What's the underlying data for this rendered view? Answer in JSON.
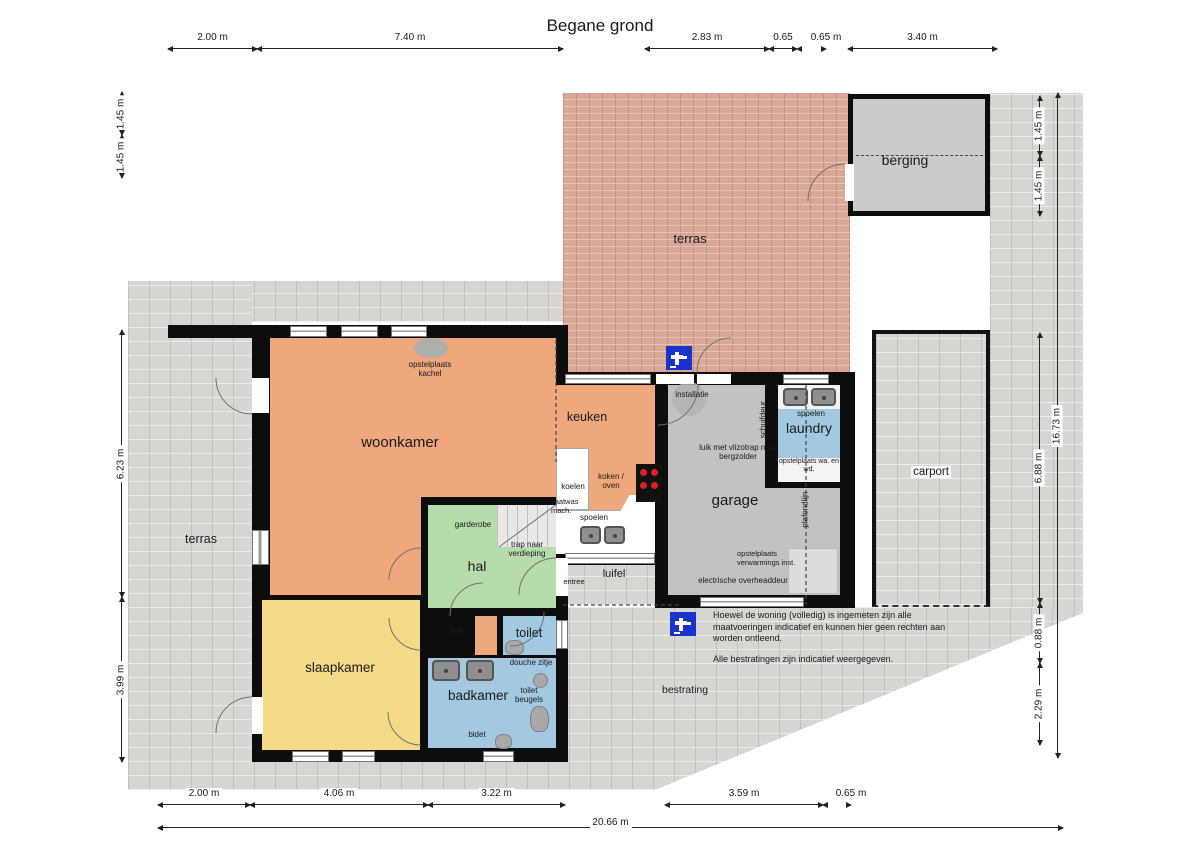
{
  "title": "Begane grond",
  "rooms": {
    "terras_top": "terras",
    "berging": "berging",
    "woonkamer": "woonkamer",
    "keuken": "keuken",
    "garage": "garage",
    "laundry": "laundry",
    "carport": "carport",
    "terras_left": "terras",
    "hal": "hal",
    "slaapkamer": "slaapkamer",
    "mk": "mk.",
    "toilet": "toilet",
    "badkamer": "badkamer",
    "bestrating": "bestrating",
    "luifel": "luifel",
    "entree": "entree"
  },
  "annotations": {
    "opstelplaats_kachel": "opstelplaats kachel",
    "installatie": "installatie",
    "schuifdeur": "schuifdeur",
    "spoelen_laundry": "spoelen",
    "opstelplaats_wasmachine": "opstelplaats wa. en wd.",
    "luik_vlizotrap": "luik met vlizotrap naar bergzolder",
    "plafondlijn": "plafondlijn",
    "opstelplaats_verwarming": "opstelplaats verwarmings inst.",
    "electrische_overheaddeur": "electrische overheaddeur",
    "koelen": "koelen",
    "koken_oven": "koken / oven",
    "vaatwas_mach": "vaatwas mach.",
    "spoelen_keuken": "spoelen",
    "garderobe": "garderobe",
    "trap_naar_verdieping": "trap naar verdieping",
    "douche_zitje": "douche zitje",
    "toilet_beugels": "toilet beugels",
    "bidet": "bidet"
  },
  "notes": {
    "measure_disclaimer": "Hoewel de woning (volledig) is ingemeten zijn alle maatvoeringen indicatief en kunnen hier geen rechten aan worden ontleend.",
    "paving_disclaimer": "Alle bestratingen zijn indicatief weergegeven."
  },
  "dimensions": {
    "top": [
      "2.00 m",
      "7.40 m",
      "2.83 m",
      "0.65",
      "0.65 m",
      "3.40 m"
    ],
    "bottom": [
      "2.00 m",
      "4.06 m",
      "3.22 m",
      "3.59 m",
      "0.65 m"
    ],
    "bottom_total": "20.66 m",
    "left": [
      "1.45 m",
      "1.45 m",
      "6.23 m",
      "3.99 m"
    ],
    "right": [
      "1.45 m",
      "1.45 m",
      "6.88 m",
      "0.88 m",
      "2.29 m"
    ],
    "right_total": "16.73 m"
  },
  "colors": {
    "wall": "#0d0d0d",
    "living_orange": "#efa77e",
    "bedroom_yellow": "#f5db88",
    "hall_green": "#b6dcab",
    "wet_blue": "#a3c9e1",
    "garage_gray": "#c2c2c2",
    "berging_gray": "#cbcbcb",
    "brick_terrace": "#d9a796",
    "paving_gray": "#d7d6d3",
    "tap_blue": "#1733cc"
  },
  "icons": {
    "tap": "water-tap-icon",
    "sink": "sink-icon",
    "cooktop": "cooktop-icon",
    "toilet": "toilet-icon",
    "stove_spot": "stove-placement-icon",
    "stairs": "stairs-icon"
  }
}
